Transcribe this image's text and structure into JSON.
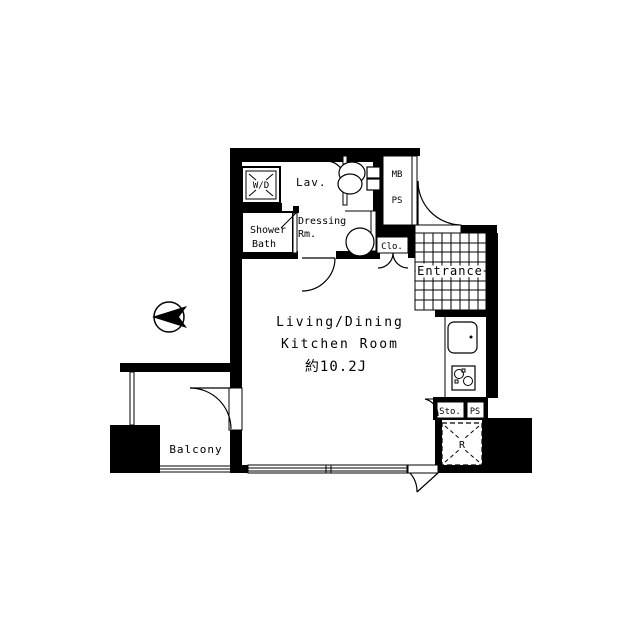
{
  "plan": {
    "type": "apartment-floorplan",
    "colors": {
      "wall": "#000000",
      "background": "#ffffff"
    },
    "compass": {
      "direction": "west-pointing-arrow"
    },
    "labels": {
      "wd": "W/D",
      "lav": "Lav.",
      "shower": "Shower",
      "bath": "Bath",
      "dressing": "Dressing",
      "dressing_rm": "Rm.",
      "mb": "MB",
      "ps_top": "PS",
      "clo": "Clo.",
      "entrance": "Entrance",
      "ldk_line1": "Living/Dining",
      "ldk_line2": "Kitchen Room",
      "ldk_size": "約10.2J",
      "sto": "Sto.",
      "ps_bottom": "PS",
      "fridge": "R",
      "balcony": "Balcony"
    }
  }
}
